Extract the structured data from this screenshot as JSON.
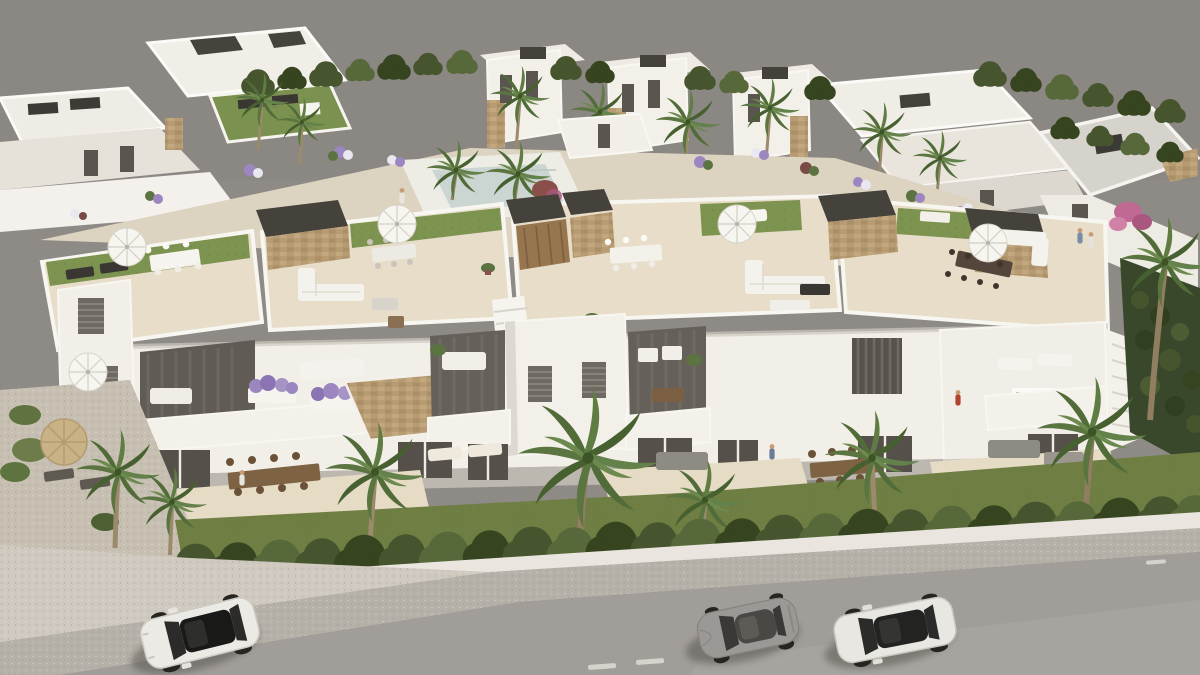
{
  "meta": {
    "kind": "architectural-3d-render",
    "view": "aerial",
    "description": "Aerial CGI render of a white Mediterranean residential development: a row of townhouses with rooftop solarium terraces in the foreground, landscaped communal gardens and further villas behind, a hedge-lined garden strip, sidewalk and asphalt street with three parked cars.",
    "visible_text": []
  },
  "palette": {
    "backdrop": "#8e8a85",
    "asphalt": "#a19d99",
    "asphalt_light": "#aca8a3",
    "slope": "#b6b1a8",
    "driveway": "#cfc9bf",
    "sidewalk": "#eae6df",
    "grass": "#6f7f44",
    "hedge": "#46552e",
    "hedge_dark": "#36451f",
    "hedge_light": "#57693a",
    "lawn": "#7d9350",
    "tile": "#e7ddc8",
    "pavement": "#dcd3c1",
    "gravel": "#c7c0b2",
    "pool": "#cbd6d2",
    "pool_deck": "#eeede5",
    "wall": "#f2efe9",
    "wall_shade": "#ddd8cf",
    "wall_dark": "#cfcac1",
    "roof_grey": "#d6d3cc",
    "stone": "#b79b72",
    "pergola": "#45413b",
    "wood_door": "#96754f",
    "wood_furniture": "#7d6244",
    "glass": "#57534c",
    "furniture_white": "#f5f3ed",
    "palm": "#5a7540",
    "palm_dark": "#47602f",
    "palm_light": "#6d8a4e",
    "trunk": "#9b8a6b",
    "car_white": "#eceae4",
    "car_grey": "#9b9896",
    "car_glass": "#222221",
    "shadow": "#4a463f",
    "flower_purple": "#9b86c0",
    "bougainvillea": "#c06a93",
    "skin": "#c99c78"
  },
  "scene": {
    "backdrop": {
      "label": "plain warm-grey background"
    },
    "back_row": {
      "label": "white flat-roof villas with tan stone accents, roof boxes and palm trees"
    },
    "communal_garden": {
      "label": "landscaped communal band with paths, flower beds, palms and a small pool"
    },
    "main_building": {
      "label": "row of townhouses with rooftop solarium terraces",
      "features": [
        "beige tiled roof terraces",
        "artificial lawn strips",
        "charcoal stair bulkheads with stone cladding",
        "white outdoor sofas",
        "dining sets",
        "white parasols",
        "balconies with purple planters",
        "ground-floor terraces with wooden dining tables"
      ]
    },
    "foreground": {
      "label": "garden strip with lawn, box hedge row, white kerb, sloped sidewalk and asphalt street"
    },
    "street": {
      "cars": [
        {
          "type": "suv",
          "color": "white",
          "roof": "black panoramic glass"
        },
        {
          "type": "coupe",
          "color": "grey"
        },
        {
          "type": "sedan",
          "color": "white",
          "roof": "dark glass"
        }
      ]
    }
  }
}
